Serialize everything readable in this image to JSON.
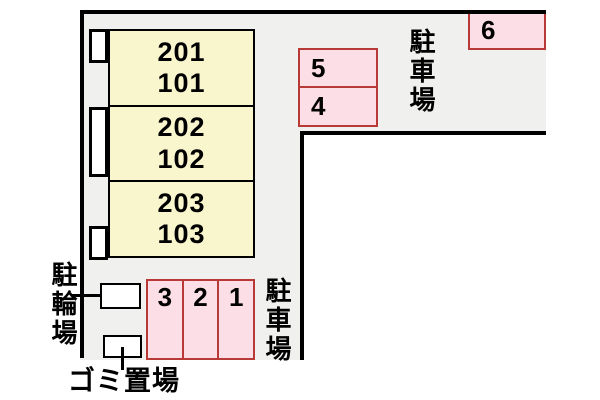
{
  "diagram": {
    "building": {
      "rooms": [
        {
          "upper": "201",
          "lower": "101"
        },
        {
          "upper": "202",
          "lower": "102"
        },
        {
          "upper": "203",
          "lower": "103"
        }
      ]
    },
    "parking_top": {
      "label": "駐車場",
      "spaces": [
        {
          "number": "6"
        },
        {
          "number": "5"
        },
        {
          "number": "4"
        }
      ]
    },
    "parking_bottom": {
      "label": "駐車場",
      "spaces": [
        {
          "number": "3"
        },
        {
          "number": "2"
        },
        {
          "number": "1"
        }
      ]
    },
    "bicycle_area": {
      "label": "駐輪場"
    },
    "garbage_area": {
      "label": "ゴミ置場"
    },
    "colors": {
      "paved_area_fill": "#f0f0ee",
      "room_fill": "#f9f5cc",
      "parking_fill": "#fcdfe6",
      "parking_border": "#b93936",
      "outline": "#000000",
      "background": "#ffffff"
    }
  }
}
